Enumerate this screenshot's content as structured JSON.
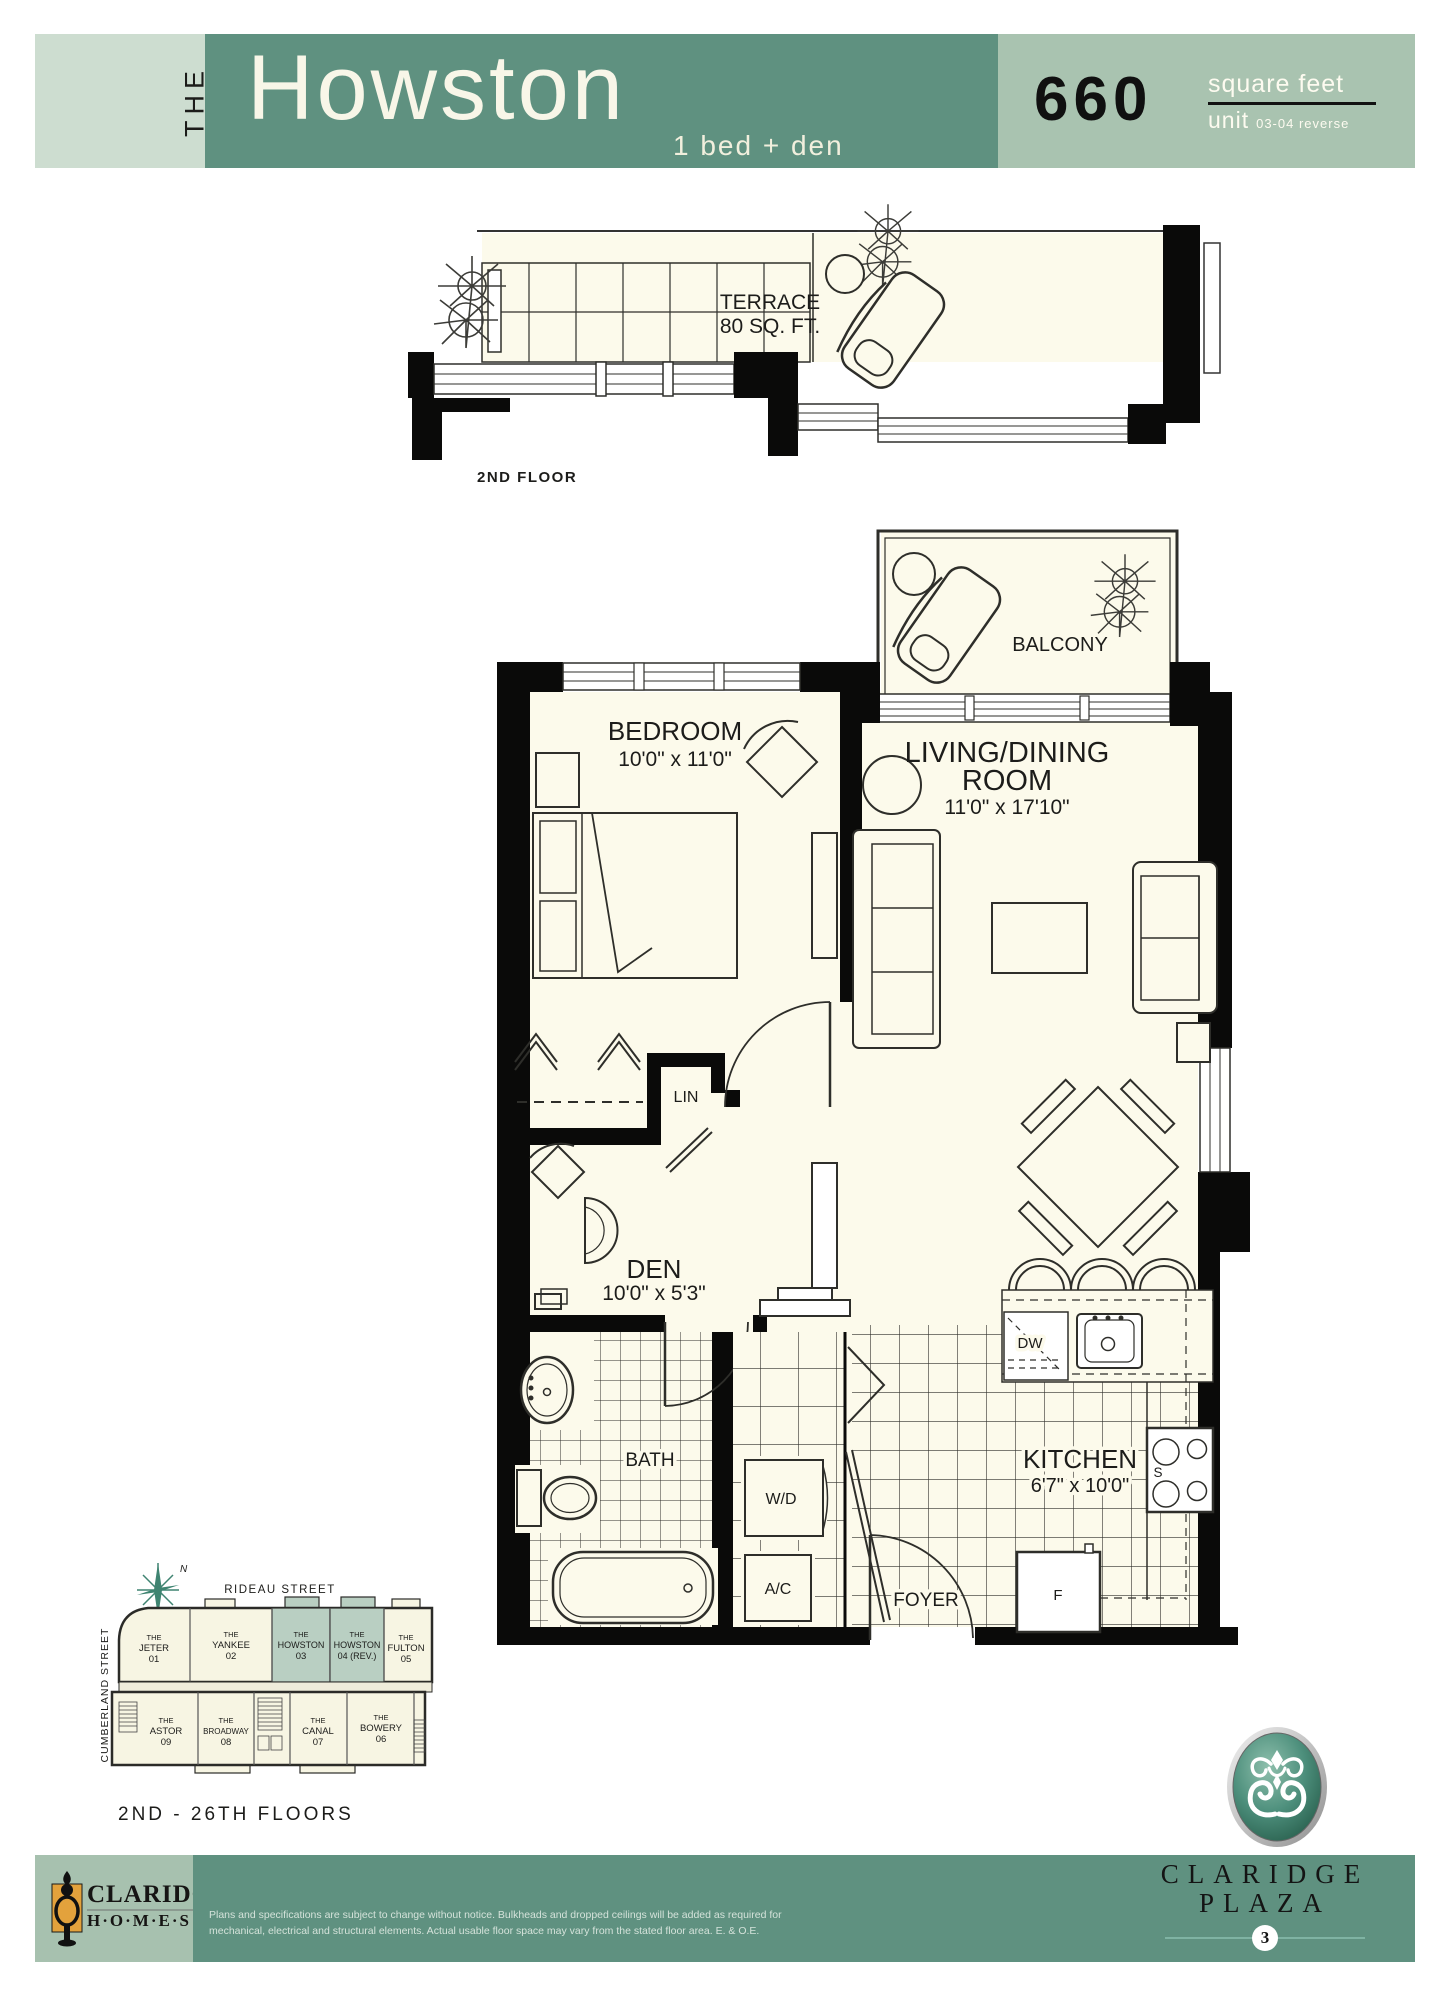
{
  "header": {
    "prefix": "THE",
    "title": "Howston",
    "subtitle": "1 bed + den",
    "area_value": "660",
    "area_unit": "square feet",
    "unit_word": "unit",
    "unit_numbers": "03-04 reverse"
  },
  "terrace": {
    "label": "TERRACE",
    "area": "80 SQ. FT.",
    "caption": "2ND FLOOR"
  },
  "rooms": {
    "balcony": "BALCONY",
    "bedroom": {
      "name": "BEDROOM",
      "dims": "10'0\" x 11'0\""
    },
    "living": {
      "line1": "LIVING/DINING",
      "line2": "ROOM",
      "dims": "11'0\" x 17'10\""
    },
    "den": {
      "name": "DEN",
      "dims": "10'0\" x 5'3\""
    },
    "bath": {
      "name": "BATH"
    },
    "kitchen": {
      "name": "KITCHEN",
      "dims": "6'7\" x 10'0\""
    },
    "foyer": {
      "name": "FOYER"
    },
    "linen": "LIN",
    "washer_dryer": "W/D",
    "air_conditioning": "A/C",
    "dishwasher": "DW",
    "stove": "S",
    "fridge": "F"
  },
  "keyplan": {
    "street_top": "RIDEAU STREET",
    "street_left": "CUMBERLAND STREET",
    "north": "N",
    "caption": "2ND - 26TH FLOORS",
    "units": [
      {
        "prefix": "THE",
        "name": "JETER",
        "num": "01",
        "highlight": false
      },
      {
        "prefix": "THE",
        "name": "YANKEE",
        "num": "02",
        "highlight": false
      },
      {
        "prefix": "THE",
        "name": "HOWSTON",
        "num": "03",
        "highlight": true
      },
      {
        "prefix": "THE",
        "name": "HOWSTON",
        "num": "04 (REV.)",
        "highlight": true
      },
      {
        "prefix": "THE",
        "name": "FULTON",
        "num": "05",
        "highlight": false
      },
      {
        "prefix": "THE",
        "name": "BOWERY",
        "num": "06",
        "highlight": false
      },
      {
        "prefix": "THE",
        "name": "CANAL",
        "num": "07",
        "highlight": false
      },
      {
        "prefix": "THE",
        "name": "BROADWAY",
        "num": "08",
        "highlight": false
      },
      {
        "prefix": "THE",
        "name": "ASTOR",
        "num": "09",
        "highlight": false
      }
    ]
  },
  "footer": {
    "builder_name": "CLARIDGE",
    "builder_suffix": "H·O·M·E·S",
    "disclaimer_line1": "Plans and specifications are subject to change without notice. Bulkheads and dropped ceilings will be added as required for",
    "disclaimer_line2": "mechanical, electrical and structural elements. Actual usable floor space may vary from the stated floor area. E. & O.E.",
    "project_name_line1": "CLARIDGE",
    "project_name_line2": "PLAZA",
    "project_number": "3"
  },
  "colors": {
    "band_light": "#cdddd0",
    "band_dark": "#5f9180",
    "band_sage": "#a9c3b0",
    "highlight_unit": "#b9cfc2",
    "room_fill": "#fcfaeb",
    "accent_teal": "#3f8471",
    "gold": "#e3a23c",
    "wall_black": "#0a0a09"
  }
}
